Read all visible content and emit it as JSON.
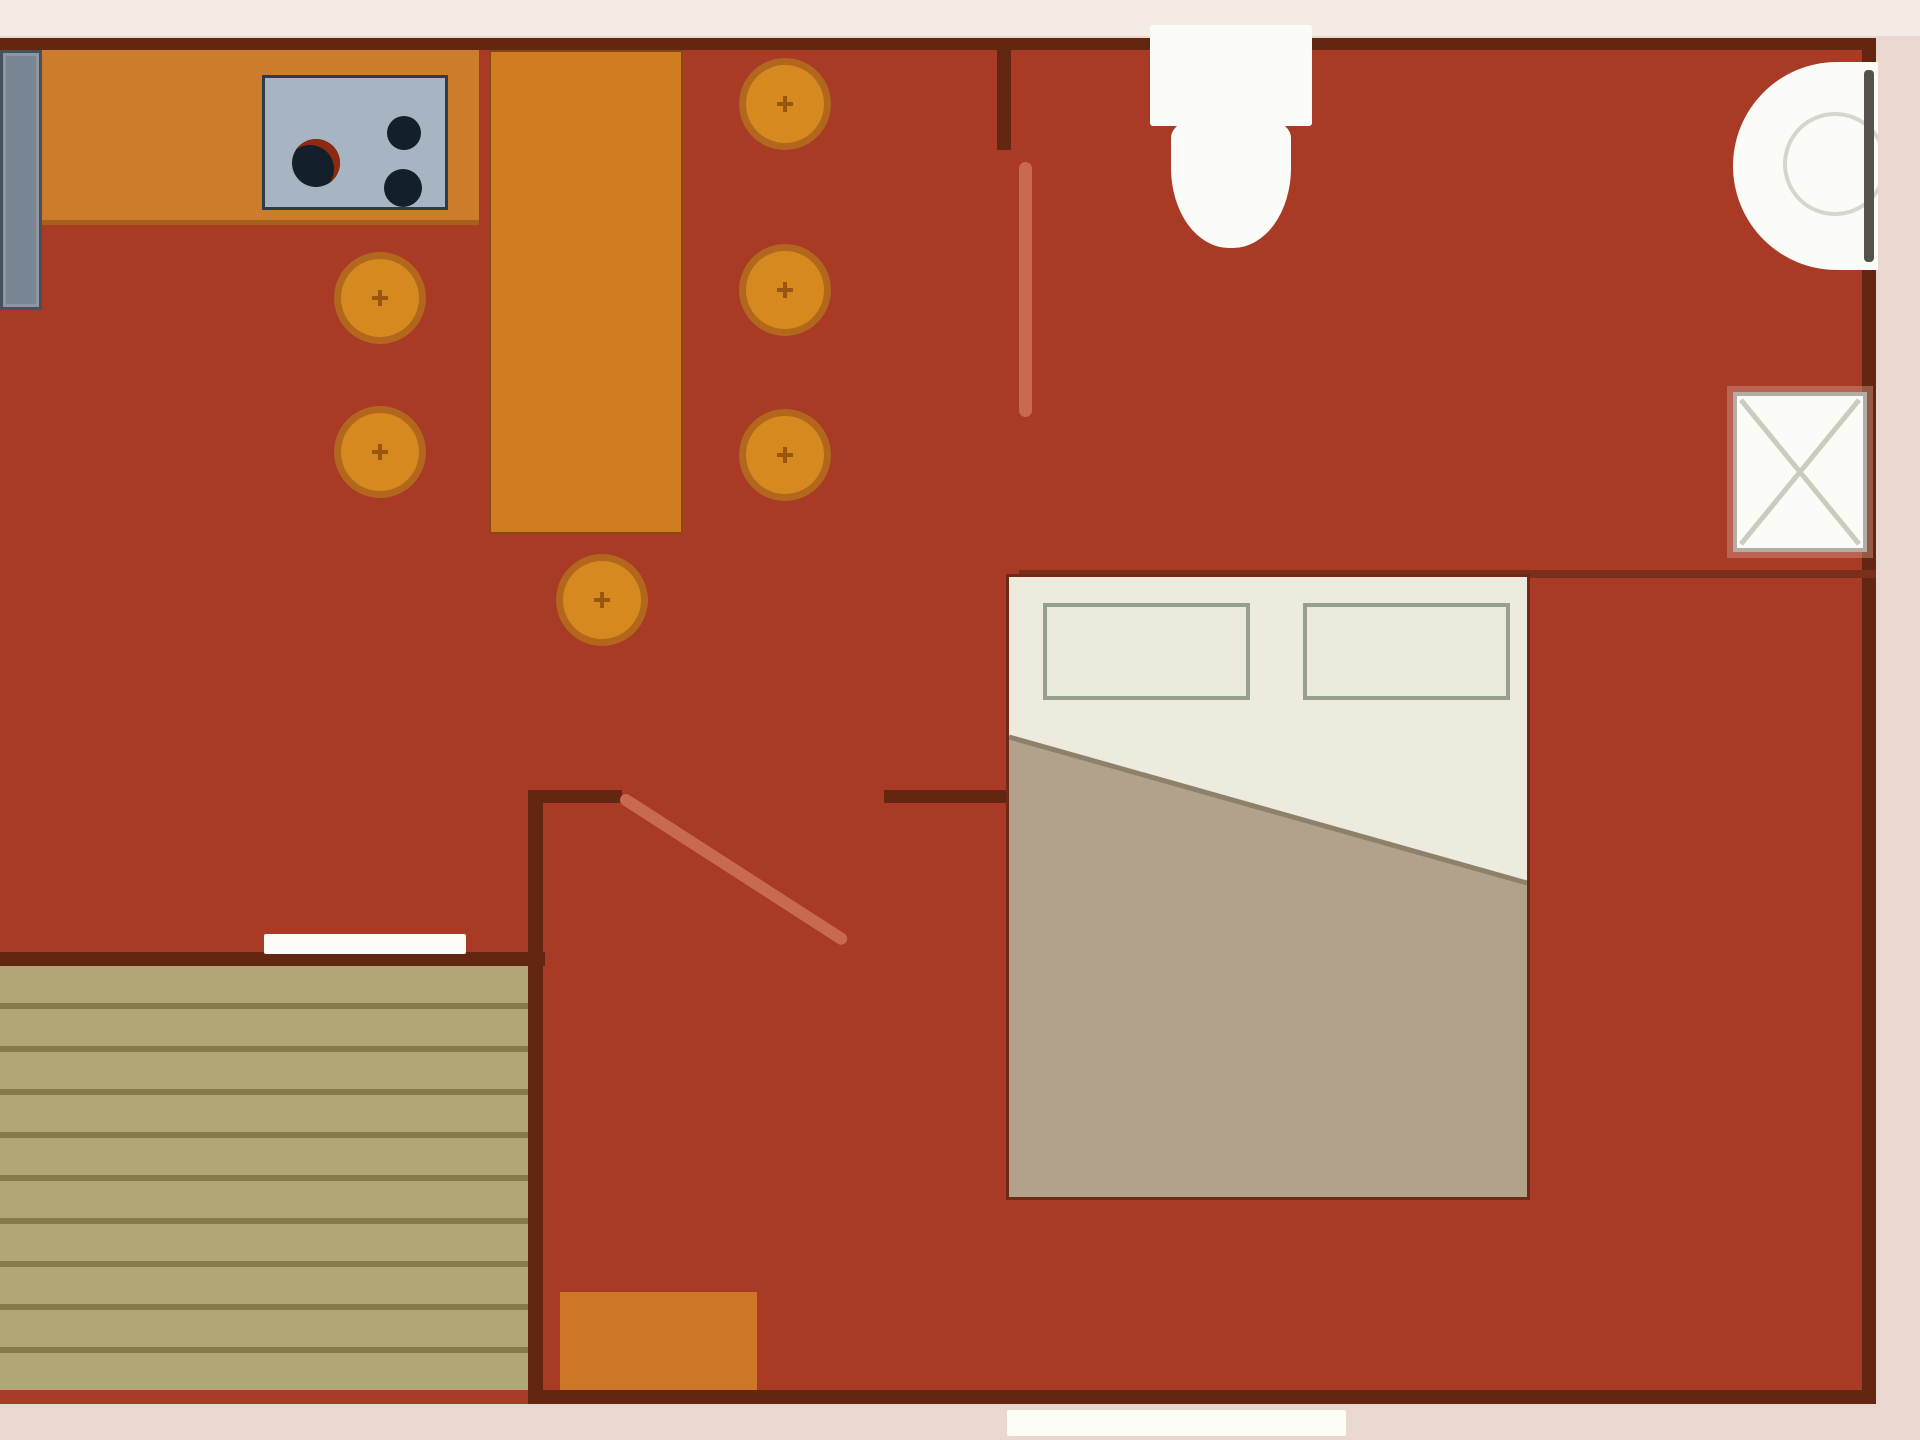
{
  "title": "apartment-floor-plan",
  "colors": {
    "border": "#e9d7d0",
    "border_top": "#f4ebe5",
    "floor": "#a83a26",
    "wall": "#632711",
    "wall_light": "#7a2f1a",
    "counter": "#cc7c2b",
    "counter_edge": "#a5601c",
    "table": "#d07c20",
    "table_edge": "#8a4712",
    "stool_fill": "#d5891f",
    "stool_ring": "#b2671c",
    "stool_mark": "#9a560f",
    "appliance_fill": "#788592",
    "appliance_edge": "#45525e",
    "stove_fill": "#a6b5c1",
    "stove_edge": "#2d3c48",
    "burner": "#131f2a",
    "burner_accent": "#8d2a12",
    "door_leaf": "#c86a50",
    "bed_sheet": "#edeade",
    "bed_outline": "#6e2a14",
    "pillow_fill": "#eae9db",
    "pillow_edge": "#97a08a",
    "blanket": "#b2a28b",
    "blanket_edge": "#8d8169",
    "deck_base": "#b3a676",
    "deck_line": "#867a4a",
    "mat": "#cd7529",
    "fixture_white": "#fbfbf8",
    "fixture_detail": "#d6d6cf",
    "sink_edge_dark": "#55524b",
    "xbox_border": "#b3aca4",
    "xbox_cross": "#c9cdbe",
    "opening_white": "#fefcf7"
  },
  "rooms": [
    {
      "name": "kitchen-dining"
    },
    {
      "name": "bathroom"
    },
    {
      "name": "bedroom"
    },
    {
      "name": "deck"
    }
  ],
  "furniture": {
    "stools": {
      "radius": 46,
      "centers": [
        [
          380,
          298
        ],
        [
          380,
          452
        ],
        [
          602,
          600
        ],
        [
          785,
          104
        ],
        [
          785,
          290
        ],
        [
          785,
          455
        ]
      ]
    },
    "stove_burners": [
      {
        "cx": 51,
        "cy": 85,
        "r": 24,
        "accent": true
      },
      {
        "cx": 139,
        "cy": 55,
        "r": 17,
        "accent": false
      },
      {
        "cx": 138,
        "cy": 110,
        "r": 19,
        "accent": false
      }
    ],
    "legend": [
      "kitchen-counter",
      "refrigerator",
      "stove",
      "dining-table",
      "bar-stool",
      "bathroom-door",
      "toilet",
      "wash-basin",
      "shower-box",
      "bedroom-door",
      "double-bed",
      "pillows",
      "blanket",
      "deck",
      "doormat",
      "door-opening",
      "window-opening"
    ]
  }
}
